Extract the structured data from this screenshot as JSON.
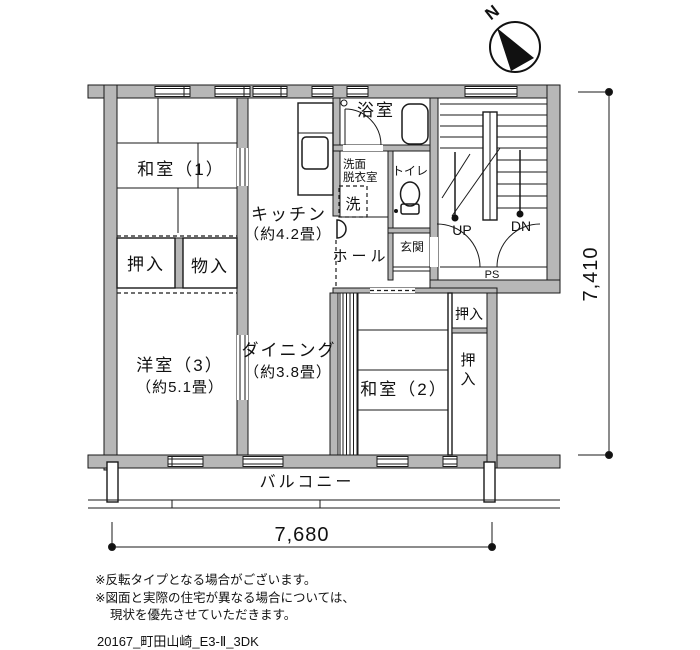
{
  "compass": {
    "north": "N"
  },
  "rooms": {
    "washitsu1": {
      "name": "和室（1）"
    },
    "oshiire_upper": {
      "name": "押入"
    },
    "mononyuu": {
      "name": "物入"
    },
    "kitchen": {
      "name": "キッチン",
      "size": "（約4.2畳）"
    },
    "bath": {
      "name": "浴室"
    },
    "washroom": {
      "name_line1": "洗面",
      "name_line2": "脱衣室",
      "washer": "洗"
    },
    "toilet": {
      "name": "トイレ"
    },
    "genkan": {
      "name": "玄関"
    },
    "hall": {
      "name": "ホール"
    },
    "yoshitsu3": {
      "name": "洋室（3）",
      "size": "（約5.1畳）"
    },
    "dining": {
      "name": "ダイニング",
      "size": "（約3.8畳）"
    },
    "washitsu2": {
      "name": "和室（2）"
    },
    "oshiire_right_top": {
      "name": "押入"
    },
    "oshiire_right": {
      "name": "押入"
    },
    "balcony": {
      "name": "バルコニー"
    }
  },
  "stairwell": {
    "up": "UP",
    "down": "DN",
    "pipe_space": "PS"
  },
  "dimensions": {
    "horizontal": "7,680",
    "vertical": "7,410"
  },
  "notes": [
    "※反転タイプとなる場合がございます。",
    "※図面と実際の住宅が異なる場合については、",
    "現状を優先させていただきます。"
  ],
  "drawing_id": "20167_町田山崎_E3-Ⅱ_3DK"
}
